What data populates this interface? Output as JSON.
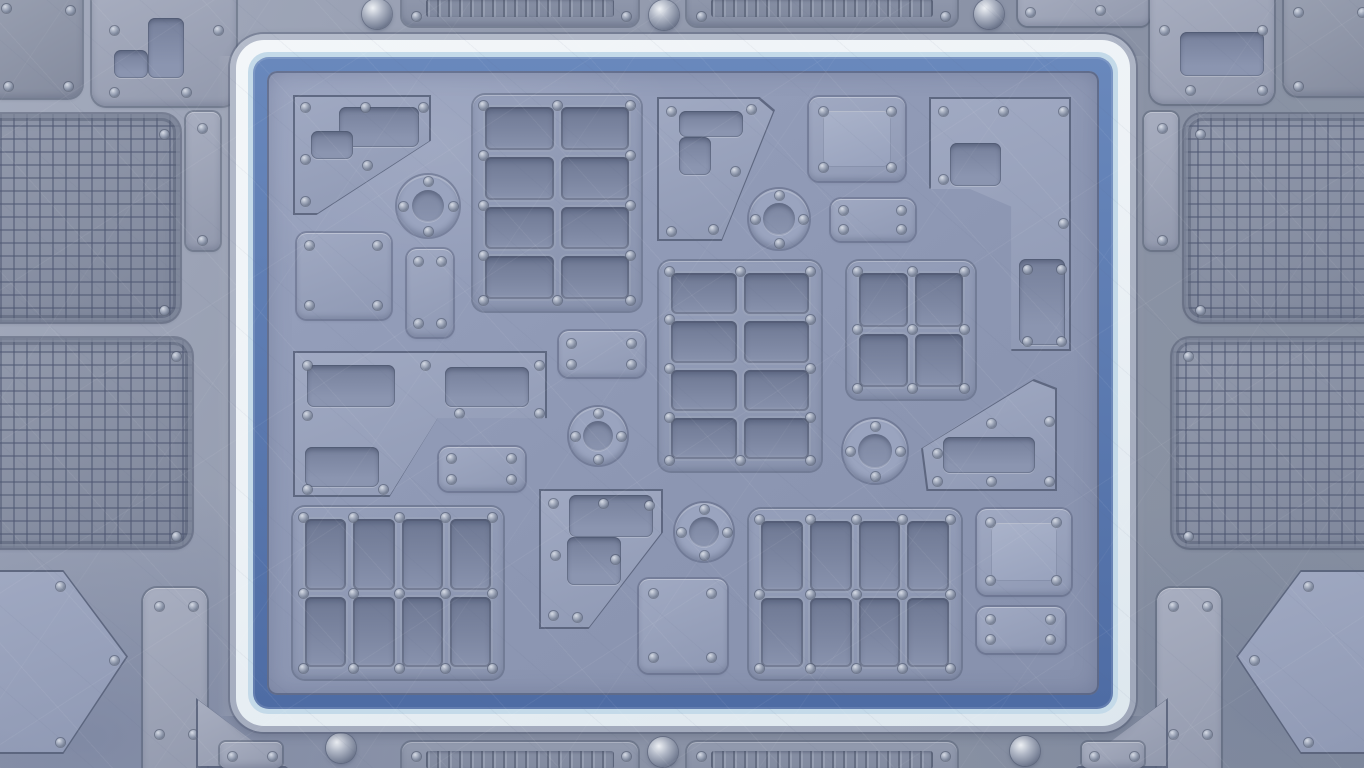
{
  "scene": {
    "type": "game-board-background",
    "theme": "industrial sci-fi riveted metal panels",
    "text_content": "none"
  },
  "palette": {
    "baseHi": "#a4abbd",
    "baseLo": "#8b93a7",
    "panelHi": "#a8aec0",
    "panelLo": "#9299ad",
    "panelDarkHi": "#9ba2b3",
    "panelDarkLo": "#848b9e",
    "boardHi": "#98a2be",
    "boardLo": "#8c96b2",
    "plateHi": "#a0a9c2",
    "plateLo": "#8f99b4",
    "groupHi": "#959fba",
    "groupLo": "#8a94af",
    "recessTop": "#76809b",
    "recessBot": "#8b95b0",
    "cellTop": "#6e7893",
    "cellBot": "#8993ae",
    "meshFill": "#8a92a6",
    "meshLine": "#4e5772",
    "frameLip": "#b4bbca",
    "frameWhite": "#edf2f6",
    "framePale": "#c4dae9",
    "frameBlueHi": "#6988bc",
    "frameBlueLo": "#4e6ca4",
    "rivetHi": "#d6dbe5",
    "rivetMid": "#98a1b4",
    "rivetLo": "#6a7489",
    "domeHi": "#eef1f5",
    "domeLo": "#555e74",
    "shadow": "#3c4763"
  },
  "board_frame": {
    "bands_outside_in": [
      "gray metal lip",
      "white band",
      "pale blue line",
      "blue band",
      "panel surface"
    ]
  },
  "inventory": {
    "interior": {
      "panel_groups_with_recessed_cells": 5,
      "circular_ports": 5,
      "riveted_plates": 14,
      "recessed_insets": 12
    },
    "exterior": {
      "mesh_grilles": 4,
      "chevron_grilles": 2,
      "ribbed_vent_strips": 4,
      "dome_bolts": 6,
      "corner_panels": 4,
      "edge_plates": 8
    }
  }
}
